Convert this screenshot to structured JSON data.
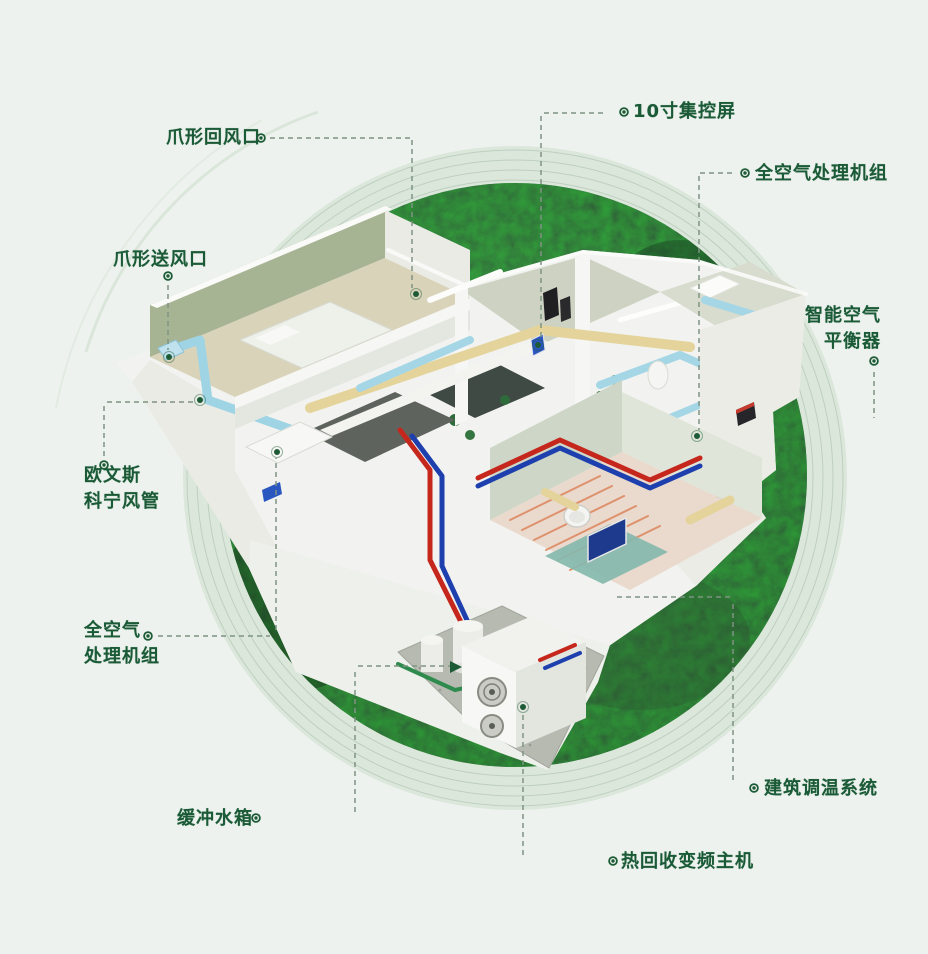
{
  "diagram": {
    "type": "isometric-cutaway-house-hvac-infographic",
    "labels": [
      {
        "id": "claw-return-vent",
        "text": "爪形回风口"
      },
      {
        "id": "control-screen",
        "text": "10寸集控屏"
      },
      {
        "id": "ahu-top-right",
        "text": "全空气处理机组"
      },
      {
        "id": "smart-air-balancer",
        "text": "智能空气\n平衡器"
      },
      {
        "id": "claw-supply-vent",
        "text": "爪形送风口"
      },
      {
        "id": "owens-corning-duct",
        "text": "欧文斯\n科宁风管"
      },
      {
        "id": "ahu-left",
        "text": "全空气\n处理机组"
      },
      {
        "id": "buffer-water-tank",
        "text": "缓冲水箱"
      },
      {
        "id": "building-temp-system",
        "text": "建筑调温系统"
      },
      {
        "id": "heat-recovery-unit",
        "text": "热回收变频主机"
      }
    ],
    "colors": {
      "page_background": "#edf2ee",
      "label_green": "#1a5a36",
      "leader_dash": "#7f9382",
      "ring_band": "#dce7dc",
      "ring_line": "#b3c7b5",
      "forest_dark": "#16301c",
      "duct_cyan": "#a5d6e6",
      "duct_yellow": "#e4d49c",
      "pipe_red": "#c5271d",
      "pipe_blue": "#1e3fae"
    }
  }
}
